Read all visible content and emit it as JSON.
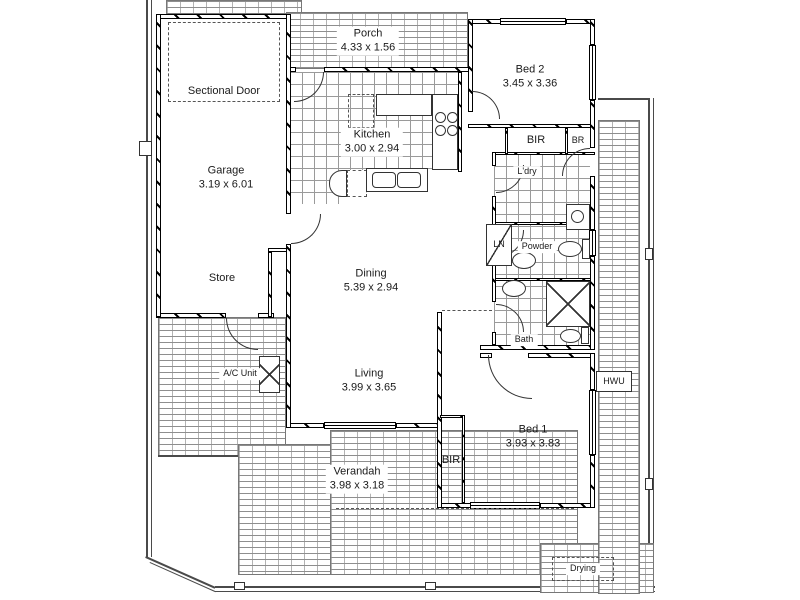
{
  "labels": {
    "porch": {
      "name": "Porch",
      "dims": "4.33 x 1.56"
    },
    "sectional_door": {
      "name": "Sectional Door"
    },
    "garage": {
      "name": "Garage",
      "dims": "3.19 x 6.01"
    },
    "store": {
      "name": "Store"
    },
    "ac_unit": {
      "name": "A/C Unit"
    },
    "kitchen": {
      "name": "Kitchen",
      "dims": "3.00 x 2.94"
    },
    "bed2": {
      "name": "Bed 2",
      "dims": "3.45 x 3.36"
    },
    "bir_bed2": {
      "name": "BIR"
    },
    "br": {
      "name": "BR"
    },
    "laundry": {
      "name": "L'dry"
    },
    "linen": {
      "name": "LN"
    },
    "powder": {
      "name": "Powder"
    },
    "bath": {
      "name": "Bath"
    },
    "dining": {
      "name": "Dining",
      "dims": "5.39 x 2.94"
    },
    "living": {
      "name": "Living",
      "dims": "3.99 x 3.65"
    },
    "bed1": {
      "name": "Bed 1",
      "dims": "3.93 x 3.83"
    },
    "bir_bed1": {
      "name": "BIR"
    },
    "hwu": {
      "name": "HWU"
    },
    "verandah": {
      "name": "Verandah",
      "dims": "3.98 x 3.18"
    },
    "drying": {
      "name": "Drying"
    }
  },
  "colors": {
    "wall_line": "#000000",
    "hatch": "#8e8e8e",
    "text": "#1a1a1a",
    "background": "#ffffff"
  }
}
